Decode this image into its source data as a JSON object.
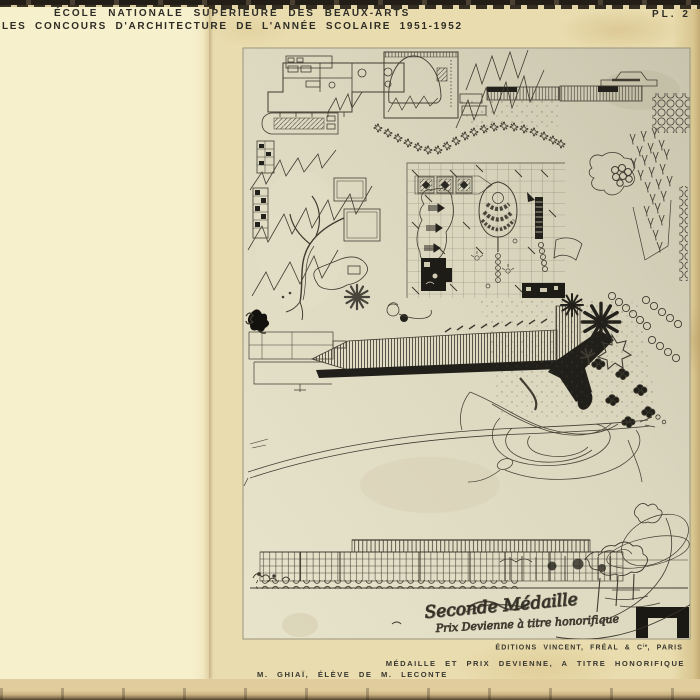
{
  "header": {
    "school": "ÉCOLE NATIONALE SUPÉRIEURE DES BEAUX-ARTS",
    "series": "LES CONCOURS D'ARCHITECTURE DE L'ANNÉE SCOLAIRE 1951-1952",
    "plate": "PL. 2"
  },
  "captions": {
    "publisher_prefix": "ÉDITIONS VINCENT, FRÉAL & C",
    "publisher_sup": "ie",
    "publisher_suffix": ", PARIS",
    "award": "MÉDAILLE ET PRIX DEVIENNE, A TITRE HONORIFIQUE",
    "author": "M. GHIAÏ, ÉLÈVE DE M. LECONTE"
  },
  "handwriting": {
    "line1": "Seconde Médaille",
    "line2": "Prix Devienne à titre honorifique"
  },
  "artwork": {
    "description": "Photographic plate of an ink site plan: gridded plaza with oval amphitheatre, gardens, trees, curved road, and long building elevation below"
  },
  "colors": {
    "paper": "#e9dcae",
    "sheet": "#f7f0cd",
    "photo_light": "#e8e3cb",
    "photo_dark": "#c8c4ad",
    "ink": "#3f3c31"
  }
}
